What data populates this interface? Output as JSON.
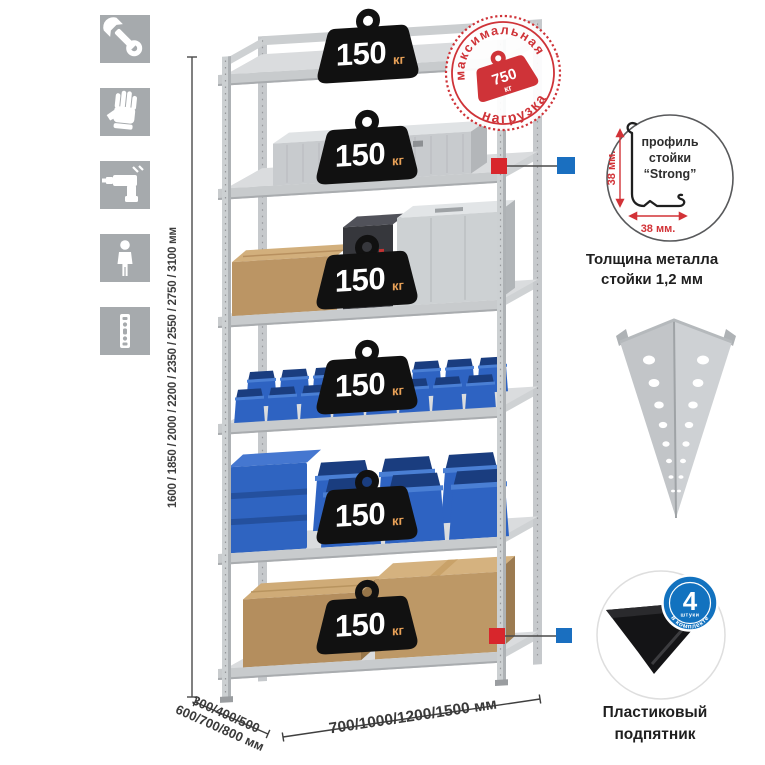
{
  "stamp": {
    "top_text": "максимальная",
    "bottom_text": "нагрузка",
    "value": "750",
    "unit": "кг"
  },
  "shelves": [
    {
      "load": "150",
      "unit": "кг",
      "contents": "empty-top-shelf"
    },
    {
      "load": "150",
      "unit": "кг",
      "contents": "aluminum-case"
    },
    {
      "load": "150",
      "unit": "кг",
      "contents": "cardboard-box-and-metal-cases"
    },
    {
      "load": "150",
      "unit": "кг",
      "contents": "small-blue-bins"
    },
    {
      "load": "150",
      "unit": "кг",
      "contents": "large-blue-bins"
    },
    {
      "load": "150",
      "unit": "кг",
      "contents": "cardboard-boxes"
    }
  ],
  "dimensions": {
    "height": "1600 / 1850 / 2000 / 2200 / 2350 / 2550 / 2750 / 3100 мм",
    "depth_line1": "300/400/500",
    "depth_line2": "600/700/800 мм",
    "width": "700/1000/1200/1500 мм"
  },
  "profile_detail": {
    "vertical_dim": "38 мм.",
    "horizontal_dim": "38 мм.",
    "label_line1": "профиль",
    "label_line2": "стойки",
    "label_line3": "“Strong”",
    "caption_line1": "Толщина металла",
    "caption_line2": "стойки 1,2 мм"
  },
  "foot_detail": {
    "badge_value": "4",
    "badge_small": "штуки",
    "badge_arc": "в комплекте",
    "caption_line1": "Пластиковый",
    "caption_line2": "подпятник"
  },
  "icons": [
    {
      "name": "wrench-icon"
    },
    {
      "name": "glove-icon"
    },
    {
      "name": "drill-icon"
    },
    {
      "name": "person-icon"
    },
    {
      "name": "profile-strip-icon"
    }
  ],
  "colors": {
    "accent_red": "#d0343a",
    "accent_blue": "#1a6fc0",
    "badge_black": "#111111",
    "kg_orange": "#e8a158",
    "icon_bg": "#a6aaad",
    "metal": "#ccd0d2",
    "bin_blue": "#2e63c2",
    "cardboard": "#b48e5e"
  }
}
